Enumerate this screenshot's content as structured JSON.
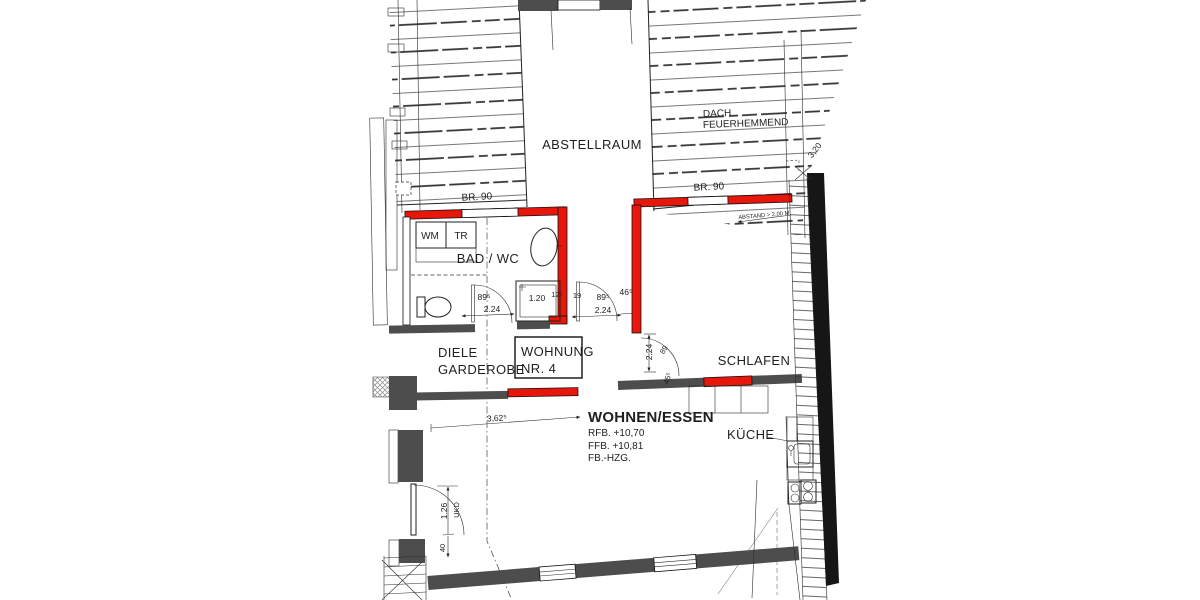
{
  "colors": {
    "red": "#e8170b",
    "wall_dark": "#4d4d4d",
    "wall_black": "#161616",
    "hatch_blue": "#5257d0",
    "ink": "#1f1f1f"
  },
  "rooms": {
    "abstellraum": "ABSTELLRAUM",
    "bad_wc": "BAD / WC",
    "diele": "DIELE",
    "garderobe": "GARDEROBE",
    "schlafen": "SCHLAFEN",
    "wohnen_essen": "WOHNEN/ESSEN",
    "kueche": "KÜCHE"
  },
  "unit": {
    "line1": "WOHNUNG",
    "line2": "NR. 4"
  },
  "levels": {
    "rfb": "RFB. +10,70",
    "ffb": "FFB. +10,81",
    "fb_hzg": "FB.-HZG."
  },
  "fire": {
    "dach_line1": "DACH",
    "dach_line2": "FEUERHEMMEND",
    "br90_left": "BR. 90",
    "br90_right": "BR. 90",
    "abstand": "ABSTAND > 2,00 M"
  },
  "appliances": {
    "wm": "WM",
    "tr": "TR"
  },
  "dimensions": {
    "roof_offset": "3,20",
    "bad_door_width": "89⁵",
    "bad_door_swing": "2.24",
    "shower": "1.20",
    "wall_12": "12⁵",
    "wall_19": "19",
    "hall_door_width": "89⁵",
    "hall_door_swing": "2.24",
    "niche_46": "46⁵",
    "schlafen_door_swing": "2.24",
    "schlafen_door_width": "89",
    "schlafen_45": "45⁵",
    "living_width": "3,62⁵",
    "entry_door": "1.26",
    "entry_ukd": "UKD",
    "entry_40": "40"
  }
}
